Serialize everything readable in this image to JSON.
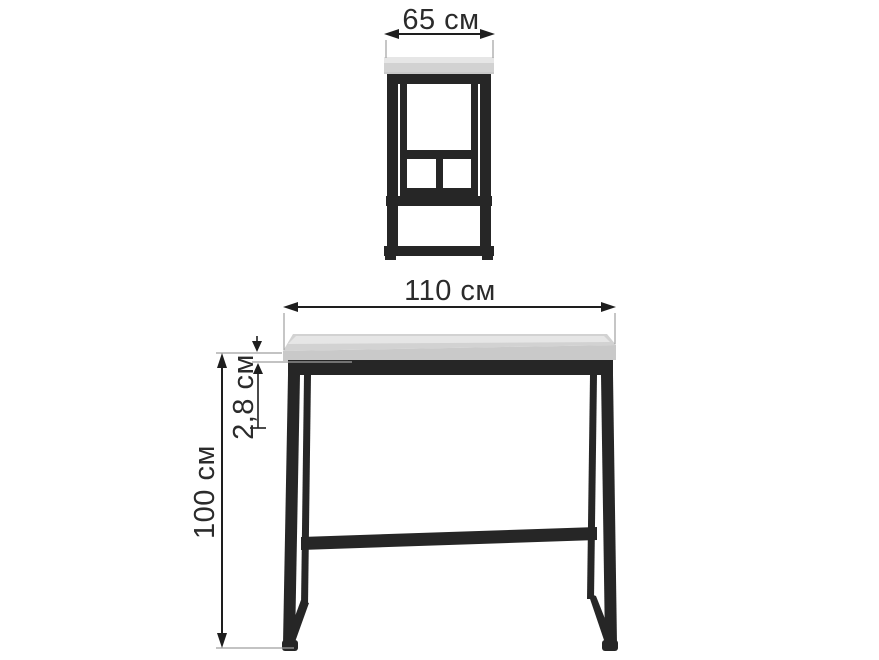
{
  "diagram": {
    "type": "furniture-dimension-drawing",
    "unit": "см",
    "colors": {
      "background": "#ffffff",
      "frame": "#262626",
      "tabletop_highlight": "#e6e6e6",
      "tabletop_surface": "#d2d2d2",
      "tabletop_front": "#c9c9c9",
      "dimension": "#1e1e1e",
      "extension_line": "#9f9f9f",
      "text": "#2b2b2b"
    },
    "dimensions": {
      "side_top_width": "65 см",
      "front_width": "110 см",
      "tabletop_thickness": "2,8 см",
      "height": "100 см"
    }
  }
}
